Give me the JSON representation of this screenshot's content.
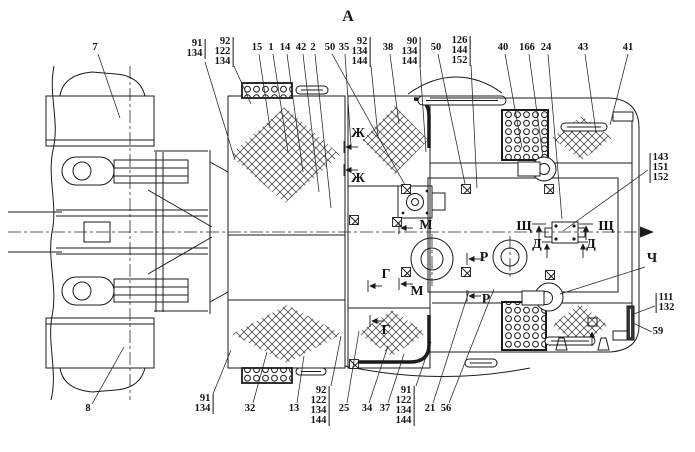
{
  "view": {
    "title": "А"
  },
  "colors": {
    "line": "#1b1b1b",
    "text": "#141414",
    "background": "#ffffff"
  },
  "callouts": [
    {
      "lines": [
        "7"
      ],
      "x": 95,
      "y": 43,
      "bar": null,
      "leader": [
        98,
        54,
        120,
        118
      ]
    },
    {
      "lines": [
        "91",
        "134"
      ],
      "x": 196,
      "y": 39,
      "bar": "right",
      "leader": [
        205,
        62,
        235,
        160
      ]
    },
    {
      "lines": [
        "92",
        "122",
        "134"
      ],
      "x": 224,
      "y": 37,
      "bar": "right",
      "leader": [
        234,
        66,
        251,
        104
      ]
    },
    {
      "lines": [
        "15"
      ],
      "x": 257,
      "y": 43,
      "bar": null,
      "leader": [
        259,
        54,
        270,
        128
      ]
    },
    {
      "lines": [
        "1"
      ],
      "x": 271,
      "y": 43,
      "bar": null,
      "leader": [
        273,
        54,
        288,
        152
      ]
    },
    {
      "lines": [
        "14"
      ],
      "x": 285,
      "y": 43,
      "bar": null,
      "leader": [
        287,
        54,
        303,
        172
      ]
    },
    {
      "lines": [
        "42"
      ],
      "x": 301,
      "y": 43,
      "bar": null,
      "leader": [
        303,
        54,
        319,
        192
      ]
    },
    {
      "lines": [
        "2"
      ],
      "x": 313,
      "y": 43,
      "bar": null,
      "leader": [
        315,
        54,
        331,
        208
      ]
    },
    {
      "lines": [
        "50"
      ],
      "x": 330,
      "y": 43,
      "bar": null,
      "leader": [
        332,
        54,
        405,
        185
      ]
    },
    {
      "lines": [
        "35"
      ],
      "x": 344,
      "y": 43,
      "bar": null,
      "leader": [
        345,
        54,
        351,
        146
      ]
    },
    {
      "lines": [
        "92",
        "134",
        "144"
      ],
      "x": 361,
      "y": 37,
      "bar": "right",
      "leader": [
        371,
        66,
        378,
        136
      ]
    },
    {
      "lines": [
        "38"
      ],
      "x": 388,
      "y": 43,
      "bar": null,
      "leader": [
        390,
        54,
        399,
        124
      ]
    },
    {
      "lines": [
        "90",
        "134",
        "144"
      ],
      "x": 411,
      "y": 37,
      "bar": "right",
      "leader": [
        420,
        66,
        426,
        152
      ]
    },
    {
      "lines": [
        "50"
      ],
      "x": 436,
      "y": 43,
      "bar": null,
      "leader": [
        438,
        54,
        465,
        184
      ]
    },
    {
      "lines": [
        "126",
        "144",
        "152"
      ],
      "x": 461,
      "y": 36,
      "bar": "right",
      "leader": [
        471,
        65,
        477,
        188
      ]
    },
    {
      "lines": [
        "40"
      ],
      "x": 503,
      "y": 43,
      "bar": null,
      "leader": [
        505,
        54,
        522,
        148
      ]
    },
    {
      "lines": [
        "166"
      ],
      "x": 527,
      "y": 43,
      "bar": null,
      "leader": [
        529,
        54,
        543,
        157
      ]
    },
    {
      "lines": [
        "24"
      ],
      "x": 546,
      "y": 43,
      "bar": null,
      "leader": [
        548,
        54,
        562,
        219
      ]
    },
    {
      "lines": [
        "43"
      ],
      "x": 583,
      "y": 43,
      "bar": null,
      "leader": [
        585,
        54,
        596,
        132
      ]
    },
    {
      "lines": [
        "41"
      ],
      "x": 628,
      "y": 43,
      "bar": null,
      "leader": [
        628,
        54,
        610,
        125
      ]
    },
    {
      "lines": [
        "143",
        "151",
        "152"
      ],
      "x": 659,
      "y": 153,
      "bar": "left",
      "leader": [
        648,
        170,
        563,
        231
      ]
    },
    {
      "lines": [
        "111",
        "132"
      ],
      "x": 665,
      "y": 293,
      "bar": "left",
      "leader": [
        655,
        306,
        631,
        315
      ]
    },
    {
      "lines": [
        "59"
      ],
      "x": 658,
      "y": 327,
      "bar": null,
      "leader": [
        652,
        332,
        633,
        323
      ]
    },
    {
      "lines": [
        "8"
      ],
      "x": 88,
      "y": 404,
      "bar": null,
      "leader": [
        92,
        404,
        124,
        347
      ]
    },
    {
      "lines": [
        "91",
        "134"
      ],
      "x": 204,
      "y": 394,
      "bar": "right",
      "leader": [
        213,
        394,
        231,
        350
      ]
    },
    {
      "lines": [
        "32"
      ],
      "x": 250,
      "y": 404,
      "bar": null,
      "leader": [
        253,
        403,
        267,
        352
      ]
    },
    {
      "lines": [
        "13"
      ],
      "x": 294,
      "y": 404,
      "bar": null,
      "leader": [
        297,
        403,
        304,
        356
      ]
    },
    {
      "lines": [
        "92",
        "122",
        "134",
        "144"
      ],
      "x": 320,
      "y": 386,
      "bar": "right",
      "leader": [
        331,
        386,
        341,
        336
      ]
    },
    {
      "lines": [
        "25"
      ],
      "x": 344,
      "y": 404,
      "bar": null,
      "leader": [
        347,
        403,
        359,
        331
      ]
    },
    {
      "lines": [
        "34"
      ],
      "x": 367,
      "y": 404,
      "bar": null,
      "leader": [
        369,
        403,
        388,
        346
      ]
    },
    {
      "lines": [
        "37"
      ],
      "x": 385,
      "y": 404,
      "bar": null,
      "leader": [
        388,
        403,
        404,
        354
      ]
    },
    {
      "lines": [
        "91",
        "122",
        "134",
        "144"
      ],
      "x": 405,
      "y": 386,
      "bar": "right",
      "leader": [
        416,
        386,
        431,
        342
      ]
    },
    {
      "lines": [
        "21"
      ],
      "x": 430,
      "y": 404,
      "bar": null,
      "leader": [
        433,
        403,
        469,
        291
      ]
    },
    {
      "lines": [
        "56"
      ],
      "x": 446,
      "y": 404,
      "bar": null,
      "leader": [
        449,
        403,
        494,
        289
      ]
    }
  ],
  "section_letters": [
    {
      "text": "Ж",
      "x": 358,
      "y": 127,
      "leader": null
    },
    {
      "text": "Ж",
      "x": 358,
      "y": 172,
      "leader": null
    },
    {
      "text": "М",
      "x": 426,
      "y": 219,
      "leader": null
    },
    {
      "text": "М",
      "x": 417,
      "y": 285,
      "leader": null
    },
    {
      "text": "Г",
      "x": 386,
      "y": 268,
      "leader": null
    },
    {
      "text": "Г",
      "x": 386,
      "y": 324,
      "leader": null
    },
    {
      "text": "Р",
      "x": 484,
      "y": 251,
      "leader": null
    },
    {
      "text": "Р",
      "x": 486,
      "y": 293,
      "leader": null
    },
    {
      "text": "Щ",
      "x": 524,
      "y": 220,
      "leader": null
    },
    {
      "text": "Щ",
      "x": 606,
      "y": 220,
      "leader": null
    },
    {
      "text": "Д",
      "x": 537,
      "y": 238,
      "leader": null
    },
    {
      "text": "Д",
      "x": 591,
      "y": 238,
      "leader": null
    },
    {
      "text": "Ч",
      "x": 652,
      "y": 252,
      "leader": [
        645,
        267,
        560,
        294
      ]
    }
  ]
}
